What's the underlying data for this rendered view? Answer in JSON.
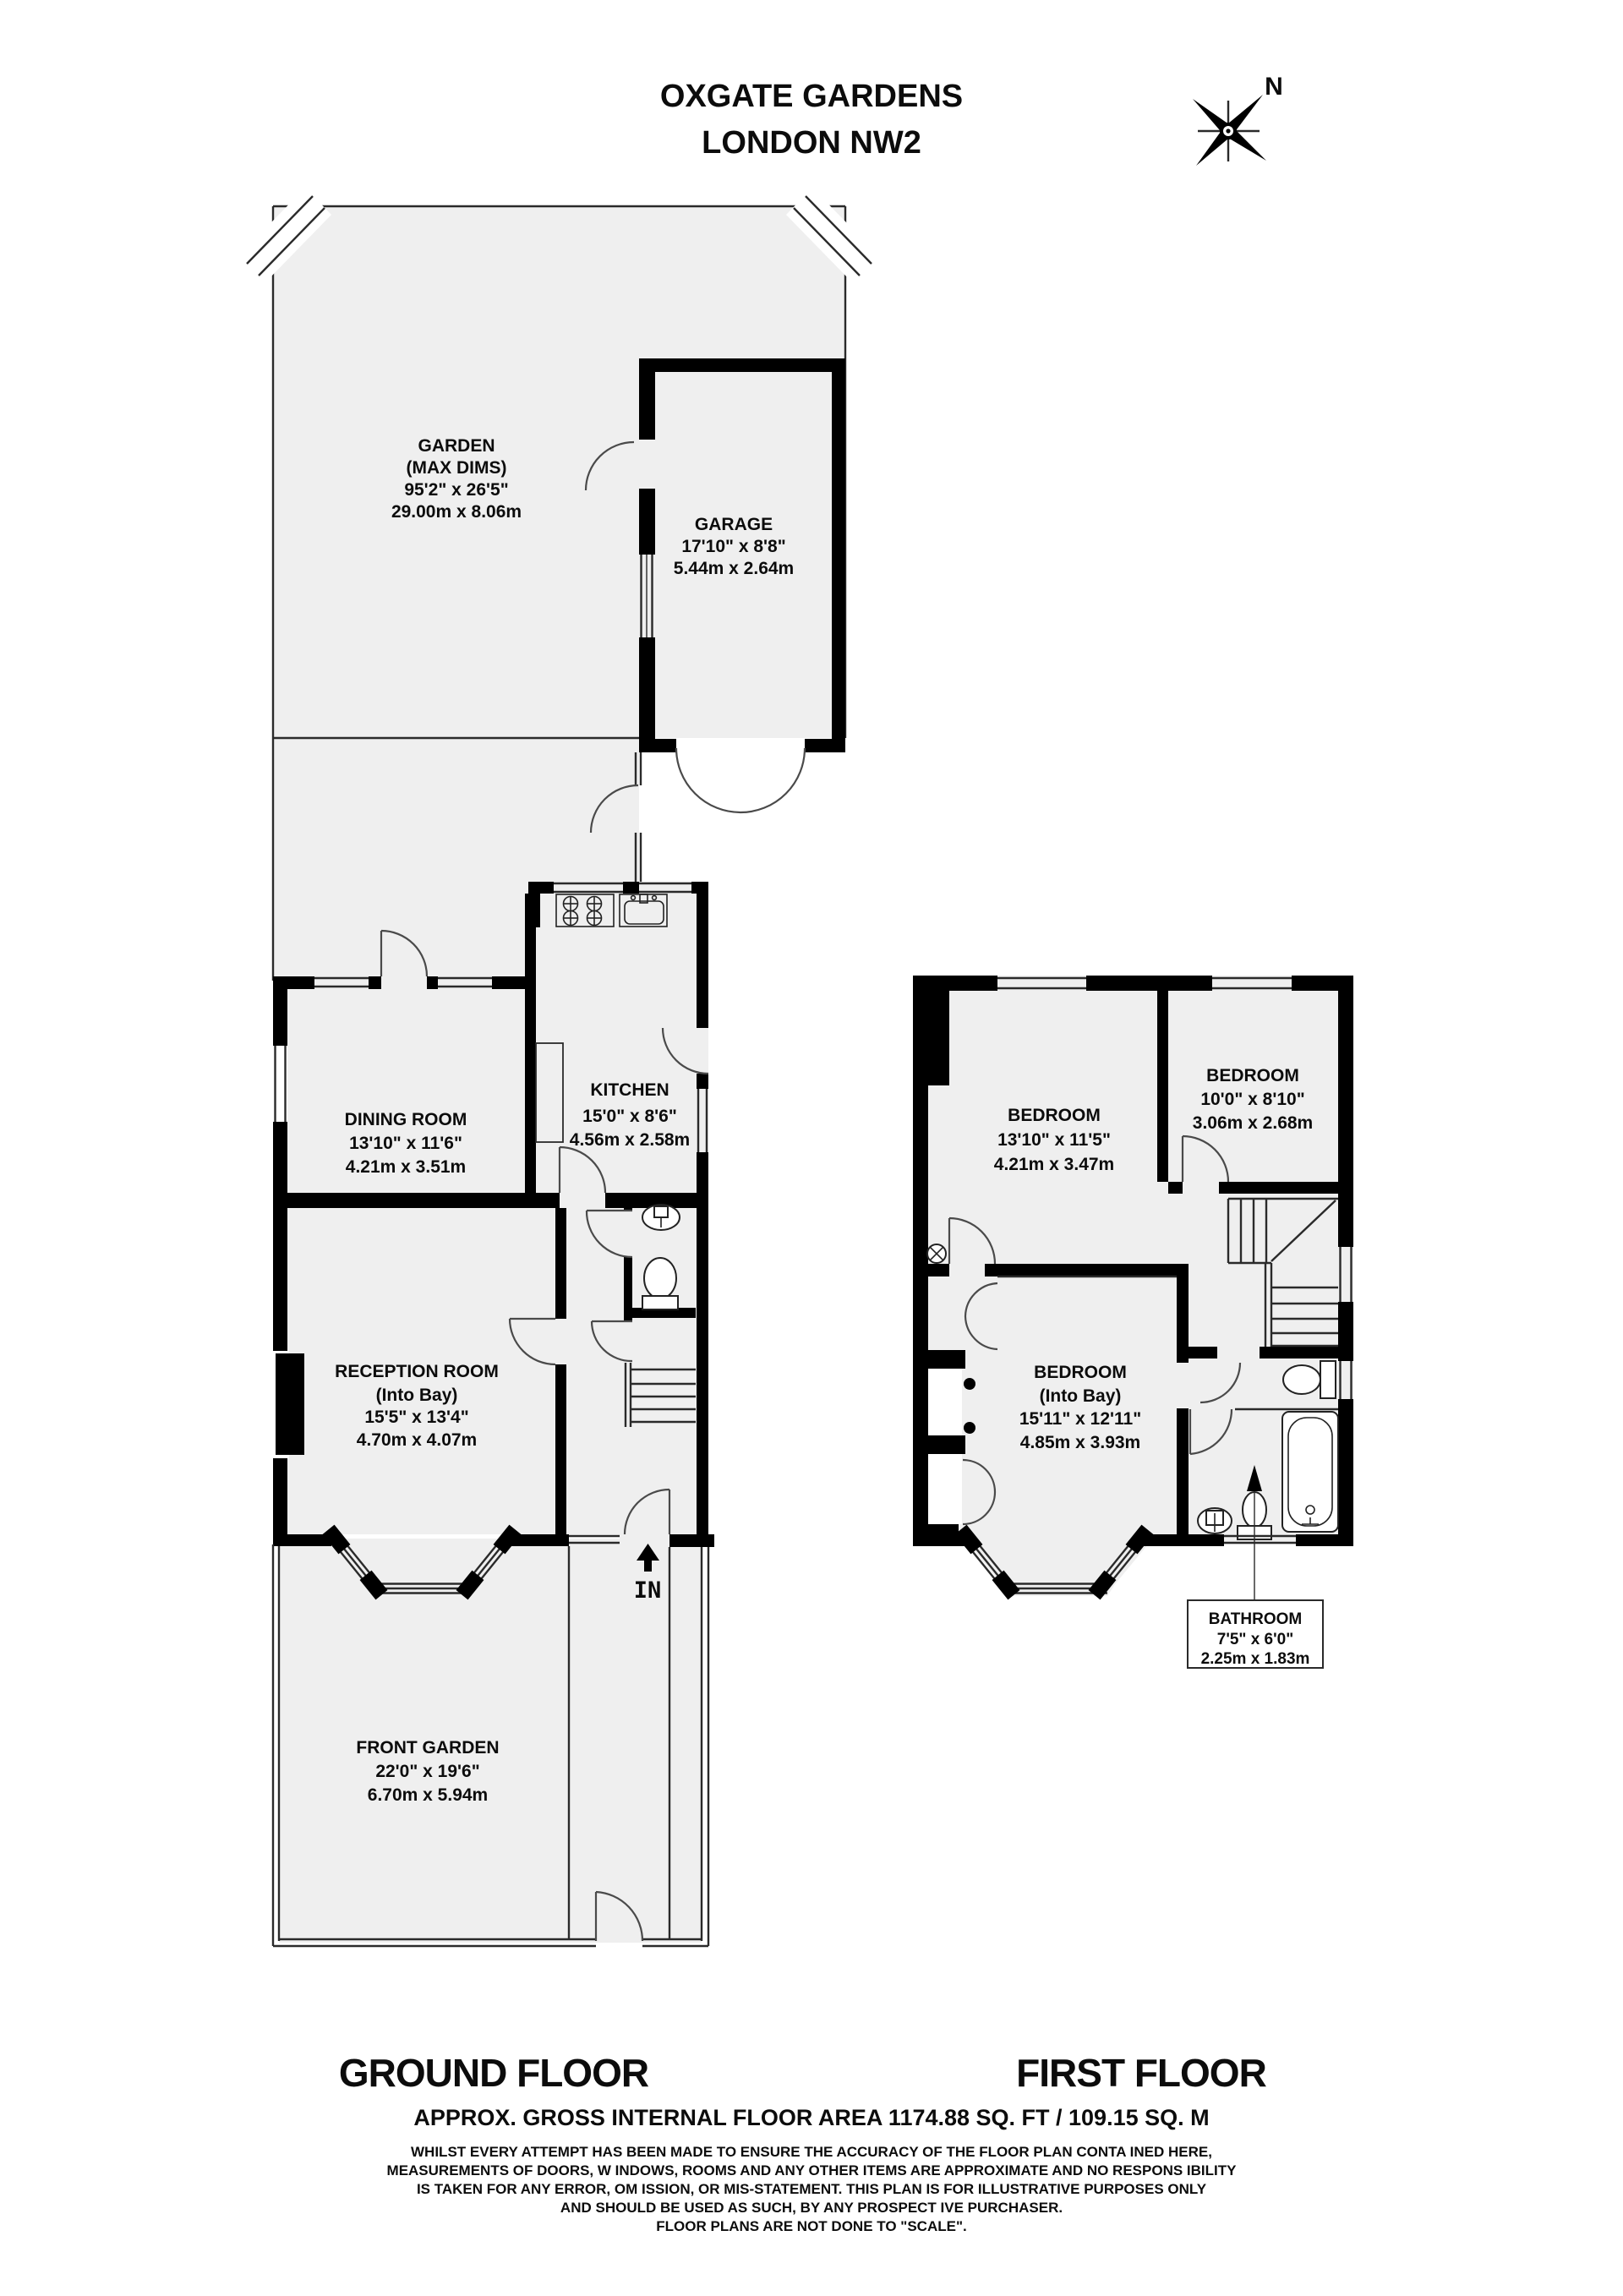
{
  "title": {
    "l1": "OXGATE GARDENS",
    "l2": "LONDON NW2"
  },
  "compass": {
    "n": "N"
  },
  "gf": {
    "garden": {
      "l1": "GARDEN",
      "l2": "(MAX DIMS)",
      "l3": "95'2\" x 26'5\"",
      "l4": "29.00m x 8.06m"
    },
    "garage": {
      "l1": "GARAGE",
      "l2": "17'10\" x 8'8\"",
      "l3": "5.44m x 2.64m"
    },
    "dining": {
      "l1": "DINING ROOM",
      "l2": "13'10\" x 11'6\"",
      "l3": "4.21m x 3.51m"
    },
    "kitchen": {
      "l1": "KITCHEN",
      "l2": "15'0\" x 8'6\"",
      "l3": "4.56m x 2.58m"
    },
    "reception": {
      "l1": "RECEPTION ROOM",
      "l2": "(Into Bay)",
      "l3": "15'5\" x 13'4\"",
      "l4": "4.70m x 4.07m"
    },
    "front_garden": {
      "l1": "FRONT GARDEN",
      "l2": "22'0\" x 19'6\"",
      "l3": "6.70m x 5.94m"
    },
    "in_label": "IN"
  },
  "ff": {
    "bedroom1": {
      "l1": "BEDROOM",
      "l2": "13'10\" x 11'5\"",
      "l3": "4.21m x 3.47m"
    },
    "bedroom2": {
      "l1": "BEDROOM",
      "l2": "10'0\" x 8'10\"",
      "l3": "3.06m x 2.68m"
    },
    "bedroom3": {
      "l1": "BEDROOM",
      "l2": "(Into Bay)",
      "l3": "15'11\" x 12'11\"",
      "l4": "4.85m x 3.93m"
    },
    "bathroom": {
      "l1": "BATHROOM",
      "l2": "7'5\" x 6'0\"",
      "l3": "2.25m x 1.83m"
    }
  },
  "footer": {
    "ground_label": "GROUND FLOOR",
    "first_label": "FIRST FLOOR",
    "area": "APPROX. GROSS INTERNAL FLOOR AREA 1174.88 SQ. FT / 109.15 SQ. M",
    "disclaimer": {
      "l1": "WHILST EVERY ATTEMPT HAS BEEN MADE TO ENSURE THE ACCURACY OF THE FLOOR PLAN CONTA INED HERE,",
      "l2": "MEASUREMENTS OF DOORS, W INDOWS, ROOMS AND ANY OTHER ITEMS ARE APPROXIMATE AND NO RESPONS IBILITY",
      "l3": "IS TAKEN FOR ANY ERROR, OM ISSION, OR MIS-STATEMENT. THIS PLAN IS FOR ILLUSTRATIVE PURPOSES ONLY",
      "l4": "AND SHOULD BE USED AS SUCH, BY ANY PROSPECT IVE PURCHASER.",
      "l5": "FLOOR PLANS ARE NOT DONE TO \"SCALE\"."
    }
  }
}
